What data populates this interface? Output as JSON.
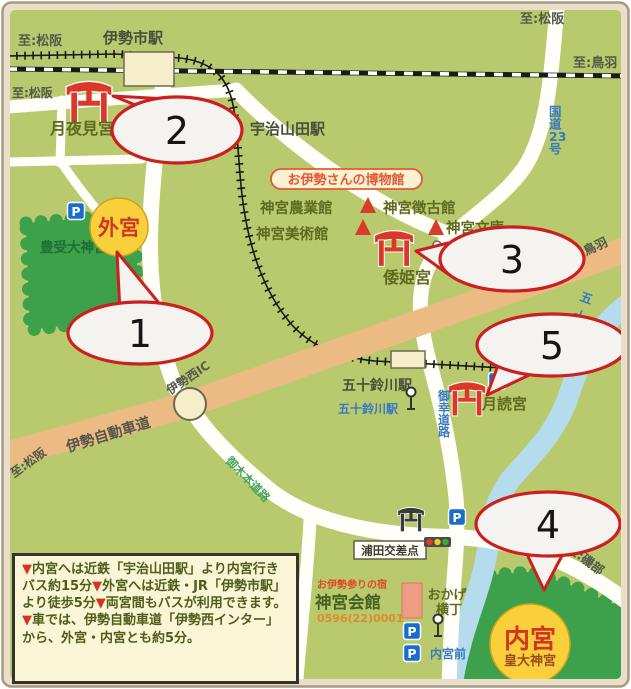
{
  "directions": {
    "matsusaka_top_left": "至:松阪",
    "matsusaka_left2": "至:松阪",
    "matsusaka_top_right": "至:松阪",
    "toba_rail": "至:鳥羽",
    "toba_expressway": "至:鳥羽",
    "matsusaka_expressway": "至:松阪",
    "isobe": "至:磯部"
  },
  "stations": {
    "iseshi": "伊勢市駅",
    "ujiyamada": "宇治山田駅",
    "isuzugawa": "五十鈴川駅",
    "isuzugawa_bus": "五十鈴川駅",
    "naiku_mae_bus": "内宮前"
  },
  "shrines": {
    "tsukiyomi_outer": "月夜見宮",
    "geku": "外宮",
    "geku_sub": "豊受大神宮",
    "yamatohime": "倭姫宮",
    "tsukiyomi": "月読宮",
    "naiku": "内宮",
    "naiku_sub": "皇大神宮"
  },
  "museums": {
    "badge": "お伊勢さんの博物館",
    "nogyokan": "神宮農業館",
    "chokokan": "神宮徴古館",
    "bijutsukan": "神宮美術館",
    "bunko": "神宮文庫"
  },
  "roads": {
    "route23": "国道23号",
    "miyuki": "御幸道路",
    "mikimoto": "御木本道路",
    "ise_expressway": "伊勢自動車道",
    "ise_nishi_ic": "伊勢西IC",
    "urata_crossing": "浦田交差点",
    "isuzu_river": "五十鈴川",
    "okage_line1": "おかげ",
    "okage_line2": "横丁"
  },
  "facilities": {
    "kaikan_tag": "お伊勢参りの宿",
    "jingu_kaikan": "神宮会館",
    "kaikan_tel": "0596(22)0001"
  },
  "icons": {
    "p_label": "P"
  },
  "callouts": {
    "n1": "1",
    "n2": "2",
    "n3": "3",
    "n4": "4",
    "n5": "5"
  },
  "info_box": {
    "m1": "▼",
    "t1": "内宮へは近鉄「宇治山田駅」より内宮行きバス約15分",
    "m2": "▼",
    "t2": "外宮へは近鉄・JR「伊勢市駅」より徒歩5分",
    "m3": "▼",
    "t3": "両宮間もバスが利用できます。",
    "m4": "▼",
    "t4": "車では、伊勢自動車道「伊勢西インター」から、外宮・内宮とも約5分。"
  },
  "colors": {
    "map_bg": "#b9ca6e",
    "forest": "#3da04b",
    "road": "#fffef8",
    "expressway": "#ecba83",
    "river": "#b5dcec",
    "torii_red": "#dc382a",
    "callout_border": "#cc1f1f",
    "shrine_circle_yellow": "#f9d03b",
    "shrine_text_red": "#d13523"
  }
}
